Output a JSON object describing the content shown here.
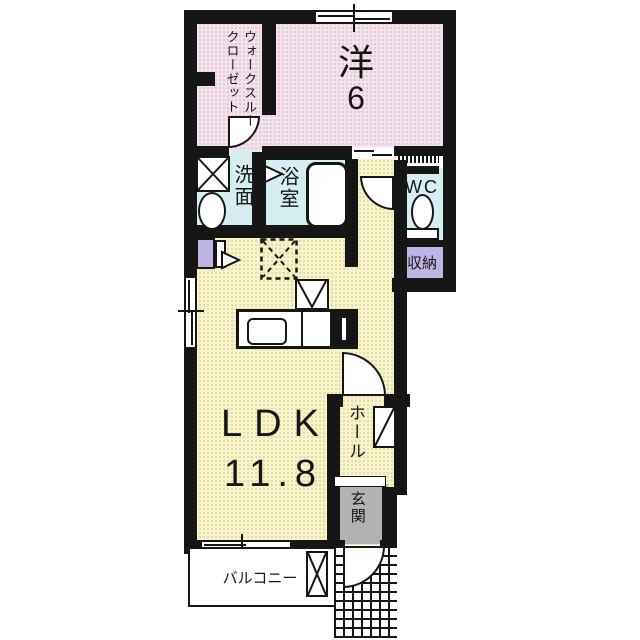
{
  "plan": {
    "rooms": {
      "walk_through_closet": {
        "line1": "ウォークスルー",
        "line2": "クローゼット"
      },
      "western_room": {
        "line1": "洋",
        "line2": "6"
      },
      "washroom": {
        "label": "洗面"
      },
      "bathroom": {
        "label": "浴室"
      },
      "wc": {
        "label": "WC"
      },
      "storage": {
        "label": "収納"
      },
      "ldk": {
        "line1": "LDK",
        "line2": "11.8"
      },
      "hall": {
        "label": "ホール"
      },
      "entrance": {
        "label": "玄関"
      },
      "balcony": {
        "label": "バルコニー"
      }
    },
    "colors": {
      "wall": "#161616",
      "room_pink": "#f6e2ec",
      "room_yellow": "#f8f3c6",
      "wet_area_blue": "#d6eef2",
      "storage_purple": "#beb3e2",
      "entrance_gray": "#b2b1b3"
    }
  }
}
